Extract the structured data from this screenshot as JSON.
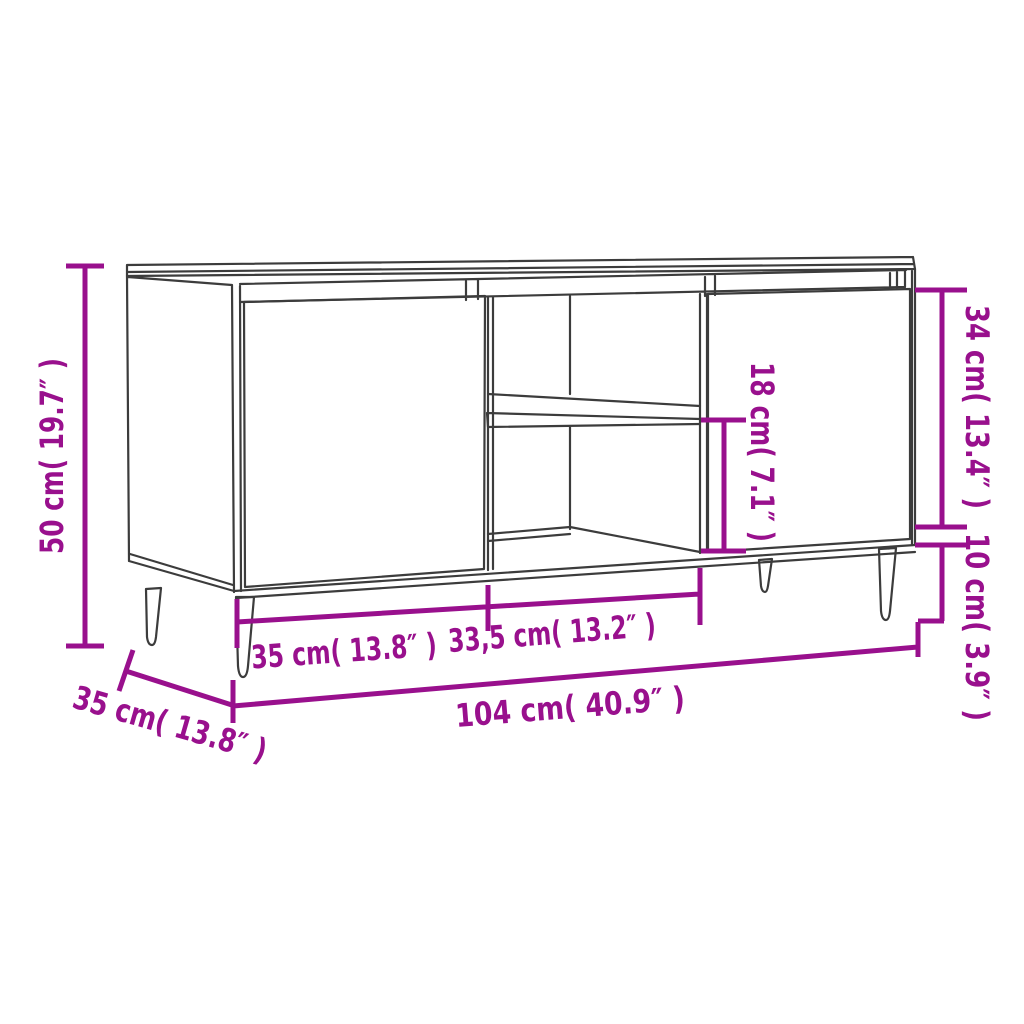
{
  "diagram": {
    "subject": "TV cabinet line drawing with two doors, open middle compartment with shelf, and four tapered legs",
    "colors": {
      "dimension": "#99108D",
      "outline": "#3C3C3C",
      "background": "#FFFFFF",
      "leg_fill": "#FFFFFF"
    },
    "labels": {
      "height": "50 cm( 19.7″ )",
      "depth": "35 cm( 13.8″ )",
      "left_section_width": "35 cm( 13.8″ )",
      "middle_section_width": "33,5 cm( 13.2″ )",
      "total_width": "104 cm( 40.9″ )",
      "shelf_opening_height": "18 cm( 7.1″ )",
      "door_height": "34 cm( 13.4″ )",
      "leg_height": "10 cm( 3.9″ )"
    }
  }
}
